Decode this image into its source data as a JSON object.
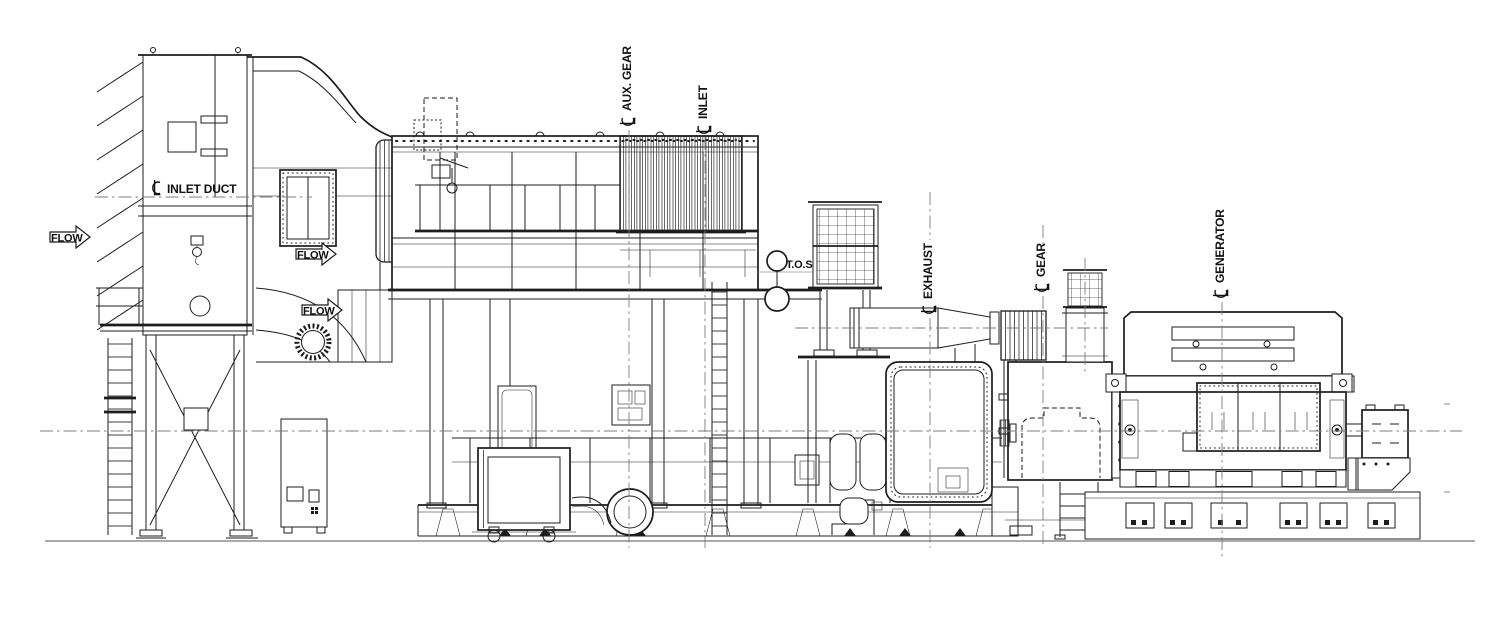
{
  "drawing": {
    "labels": {
      "flow": "FLOW",
      "inlet_duct": "INLET DUCT",
      "aux_gear": "AUX. GEAR",
      "inlet": "INLET",
      "tos": "T.O.S",
      "exhaust": "EXHAUST",
      "gear": "GEAR",
      "generator": "GENERATOR"
    },
    "symbols": {
      "centerline_symbol": "℄",
      "flow_arrow": "block arrow pointing right"
    },
    "colors": {
      "ink": "#1d1d1d",
      "background": "#ffffff",
      "centerline_gray": "#7d7d7d",
      "level_line_gray": "#9a9a9a"
    }
  }
}
